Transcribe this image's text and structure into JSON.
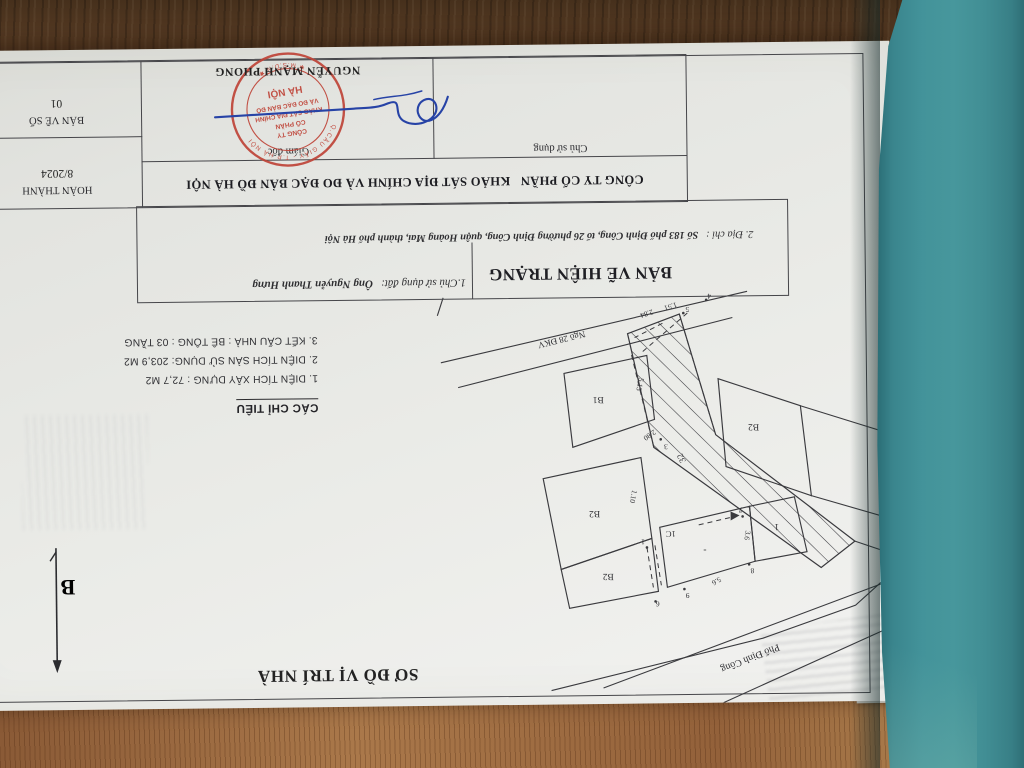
{
  "scene": {
    "description": "photo of an upside-down land survey sheet on a wooden table with a teal book cover rolled back",
    "cover_color": "#3f8e95",
    "stamp_color": "#bf4438",
    "signature_color": "#2743a6"
  },
  "doc": {
    "map_title": "SƠ ĐỒ VỊ TRÍ NHÀ",
    "north_label": "B",
    "indicators": {
      "title": "CÁC CHỈ TIÊU",
      "items": [
        "1. DIỆN TÍCH XÂY DỰNG : 72,7 M2",
        "2. DIỆN TÍCH SÀN SỬ DỤNG: 203,9 M2",
        "3. KẾT CẤU NHÀ : BÊ TÔNG : 03 TẦNG"
      ]
    },
    "info": {
      "title": "BẢN VẼ HIỆN TRẠNG",
      "line1_label": "1.Chủ sử dụng đất:",
      "line1_value": "Ông Nguyễn Thanh Hưng",
      "line2_label": "2. Địa chỉ :",
      "line2_value": "Số 183 phố Định Công, tổ 26 phường Định Công, quận Hoàng Mai, thành phố Hà Nội"
    },
    "company": "CÔNG TY CỔ PHẦN   KHẢO SÁT ĐỊA CHÍNH VÀ ĐO ĐẠC BẢN ĐỒ HÀ NỘI",
    "sign": {
      "user": "Chủ sử dụng",
      "director": "Giám đốc",
      "name": "NGUYỄN MẠNH PHONG",
      "done_label": "HOÀN THÀNH",
      "done_value": "8/2024",
      "sheet_label": "BẢN VẼ SỐ",
      "sheet_value": "01"
    },
    "stamp": {
      "l1": "CÔNG TY",
      "l2": "CỔ PHẦN",
      "l3": "KHẢO SÁT ĐỊA CHÍNH",
      "l4": "VÀ ĐO ĐẠC BẢN ĐỒ",
      "l5": "HÀ NỘI",
      "ring_top": "Q.CẦU GIẤY - T.P HÀ NỘI",
      "ring_bottom": "✱ M.S.D.N ✱"
    },
    "plan": {
      "street": "Phố Định Công",
      "alley": "Ngõ 28 ĐKV",
      "b1": "B1",
      "b2a": "B2",
      "b2b": "B2",
      "b2c": "B2",
      "p_one": "1",
      "c1": "1C",
      "subject": "32",
      "dash": "-",
      "pt1": "1",
      "pt3": "3",
      "pt4": "4",
      "pt5": "5",
      "pt6": "6",
      "pt7": "7",
      "pt8": "8",
      "pt9": "9",
      "d280": "2.80",
      "d110": "1.10",
      "d513": "5.13",
      "d284": "2.84",
      "d151": "1.51",
      "d36": "3.6",
      "d56": "5.6"
    }
  }
}
